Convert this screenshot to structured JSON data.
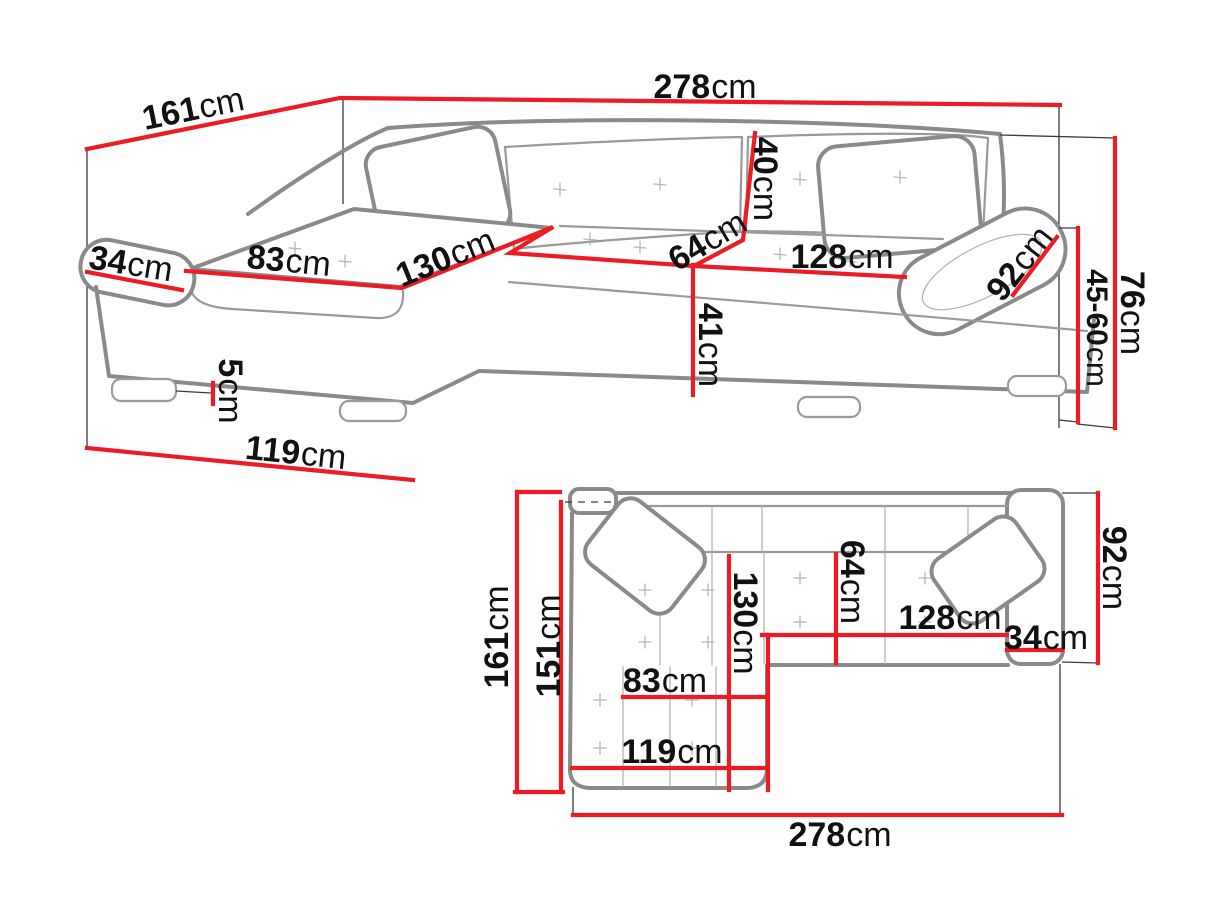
{
  "diagram_type": "corner-sofa-dimension-diagram",
  "unit": "cm",
  "colors": {
    "dimension_red": "#ed1c24",
    "outline_gray": "#8a8a8a",
    "text_black": "#111111"
  },
  "views": {
    "perspective": {
      "name": "front perspective view",
      "labels": [
        {
          "id": "overall-width",
          "value": "278",
          "unit": "cm"
        },
        {
          "id": "overall-depth",
          "value": "161",
          "unit": "cm"
        },
        {
          "id": "left-armrest-width",
          "value": "34",
          "unit": "cm"
        },
        {
          "id": "chaise-seat-width",
          "value": "83",
          "unit": "cm"
        },
        {
          "id": "chaise-seat-length",
          "value": "130",
          "unit": "cm"
        },
        {
          "id": "backrest-height",
          "value": "40",
          "unit": "cm"
        },
        {
          "id": "seat-depth",
          "value": "64",
          "unit": "cm"
        },
        {
          "id": "seat-width",
          "value": "128",
          "unit": "cm"
        },
        {
          "id": "right-armrest-length",
          "value": "92",
          "unit": "cm"
        },
        {
          "id": "seat-height",
          "value": "41",
          "unit": "cm"
        },
        {
          "id": "total-height",
          "value": "76",
          "unit": "cm"
        },
        {
          "id": "height-range",
          "value": "45-60",
          "unit": "cm"
        },
        {
          "id": "leg-height",
          "value": "5",
          "unit": "cm"
        },
        {
          "id": "chaise-front-width",
          "value": "119",
          "unit": "cm"
        }
      ]
    },
    "plan": {
      "name": "top-down plan view",
      "labels": [
        {
          "id": "overall-depth",
          "value": "161",
          "unit": "cm"
        },
        {
          "id": "chaise-length-inner",
          "value": "151",
          "unit": "cm"
        },
        {
          "id": "chaise-seat-length",
          "value": "130",
          "unit": "cm"
        },
        {
          "id": "seat-depth",
          "value": "64",
          "unit": "cm"
        },
        {
          "id": "seat-width",
          "value": "128",
          "unit": "cm"
        },
        {
          "id": "right-armrest-width",
          "value": "34",
          "unit": "cm"
        },
        {
          "id": "right-armrest-length",
          "value": "92",
          "unit": "cm"
        },
        {
          "id": "chaise-seat-width",
          "value": "83",
          "unit": "cm"
        },
        {
          "id": "chaise-front-width",
          "value": "119",
          "unit": "cm"
        },
        {
          "id": "overall-width",
          "value": "278",
          "unit": "cm"
        }
      ]
    }
  }
}
